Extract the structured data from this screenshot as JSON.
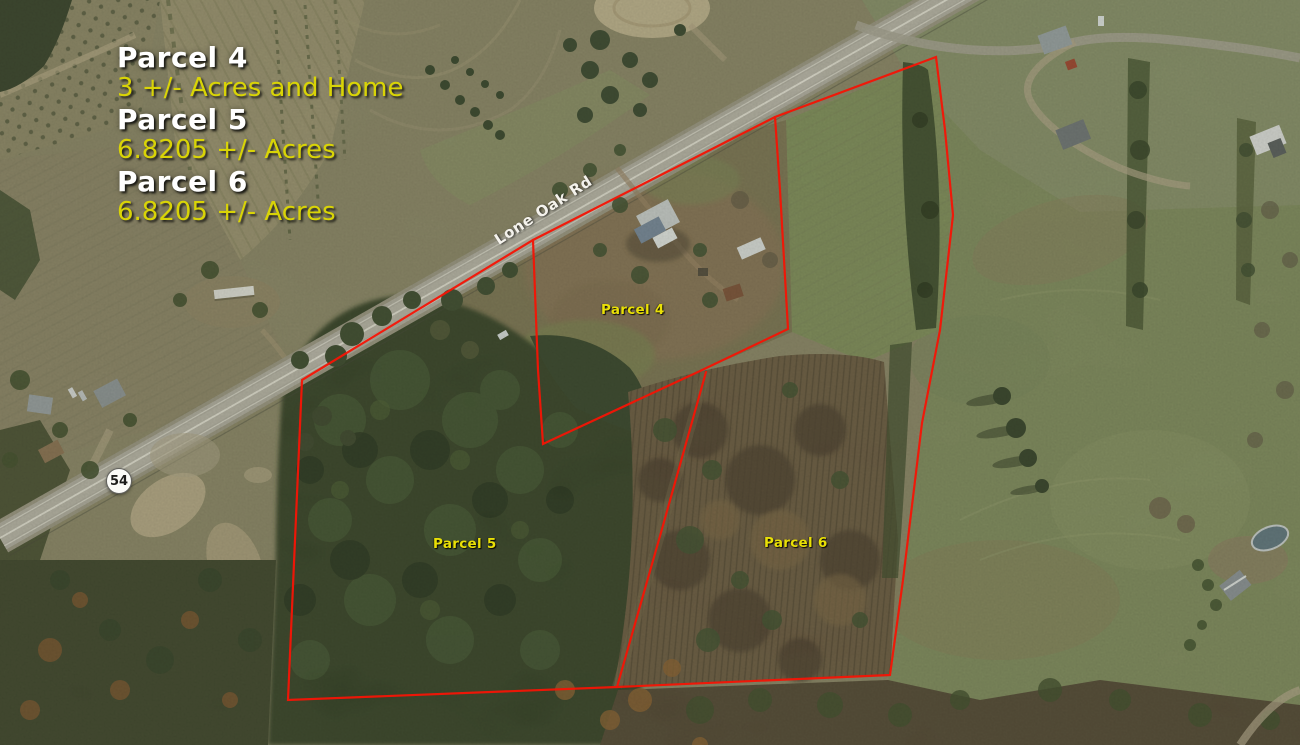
{
  "legend": {
    "items": [
      {
        "title": "Parcel 4",
        "subtitle": "3 +/- Acres and Home"
      },
      {
        "title": "Parcel 5",
        "subtitle": "6.8205 +/- Acres"
      },
      {
        "title": "Parcel 6",
        "subtitle": "6.8205 +/- Acres"
      }
    ]
  },
  "map": {
    "parcel_labels": {
      "parcel4": "Parcel 4",
      "parcel5": "Parcel 5",
      "parcel6": "Parcel 6"
    },
    "road": {
      "name": "Lone Oak Rd",
      "route_shield": "54"
    },
    "colors": {
      "boundary_red": "#f51405",
      "parcel_label_yellow": "#e9e006",
      "legend_title_white": "#ffffff",
      "legend_value_yellow": "#d9d406"
    },
    "boundaries": {
      "outer": "302,380 533,240 775,117 936,57 945,130 953,215 940,330 922,423 903,580 890,675 617,687 288,700",
      "parcel4": "775,117 780,190 788,329 700,371 543,444 538,370 533,240",
      "divider_5_6": "706,372 662,529 617,687"
    }
  }
}
